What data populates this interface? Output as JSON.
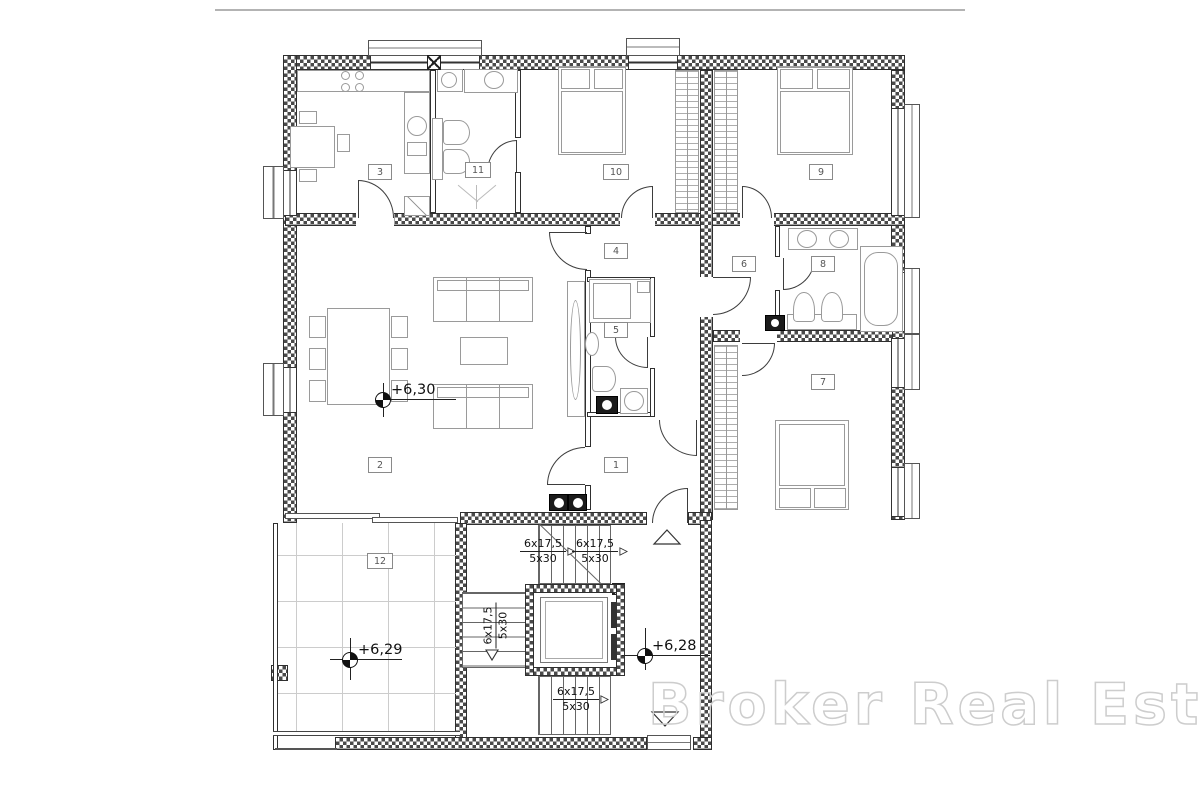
{
  "watermark": {
    "text": "Broker Real Estate"
  },
  "room_labels": [
    "1",
    "2",
    "3",
    "4",
    "5",
    "6",
    "7",
    "8",
    "9",
    "10",
    "11",
    "12"
  ],
  "elevation_markers": [
    {
      "value": "+6,30"
    },
    {
      "value": "+6,29"
    },
    {
      "value": "+6,28"
    }
  ],
  "stairs": {
    "rise": "6x17,5",
    "going": "5x30"
  },
  "colors": {
    "wall_hatch": "#4a4a4a",
    "wall_line": "#2f2f2f",
    "furniture_line": "#9a9a9a",
    "stair_line": "#666666",
    "tile_line": "#cccccc",
    "watermark_outline": "#cdcdcd",
    "top_border_line": "#b3b3b3"
  }
}
